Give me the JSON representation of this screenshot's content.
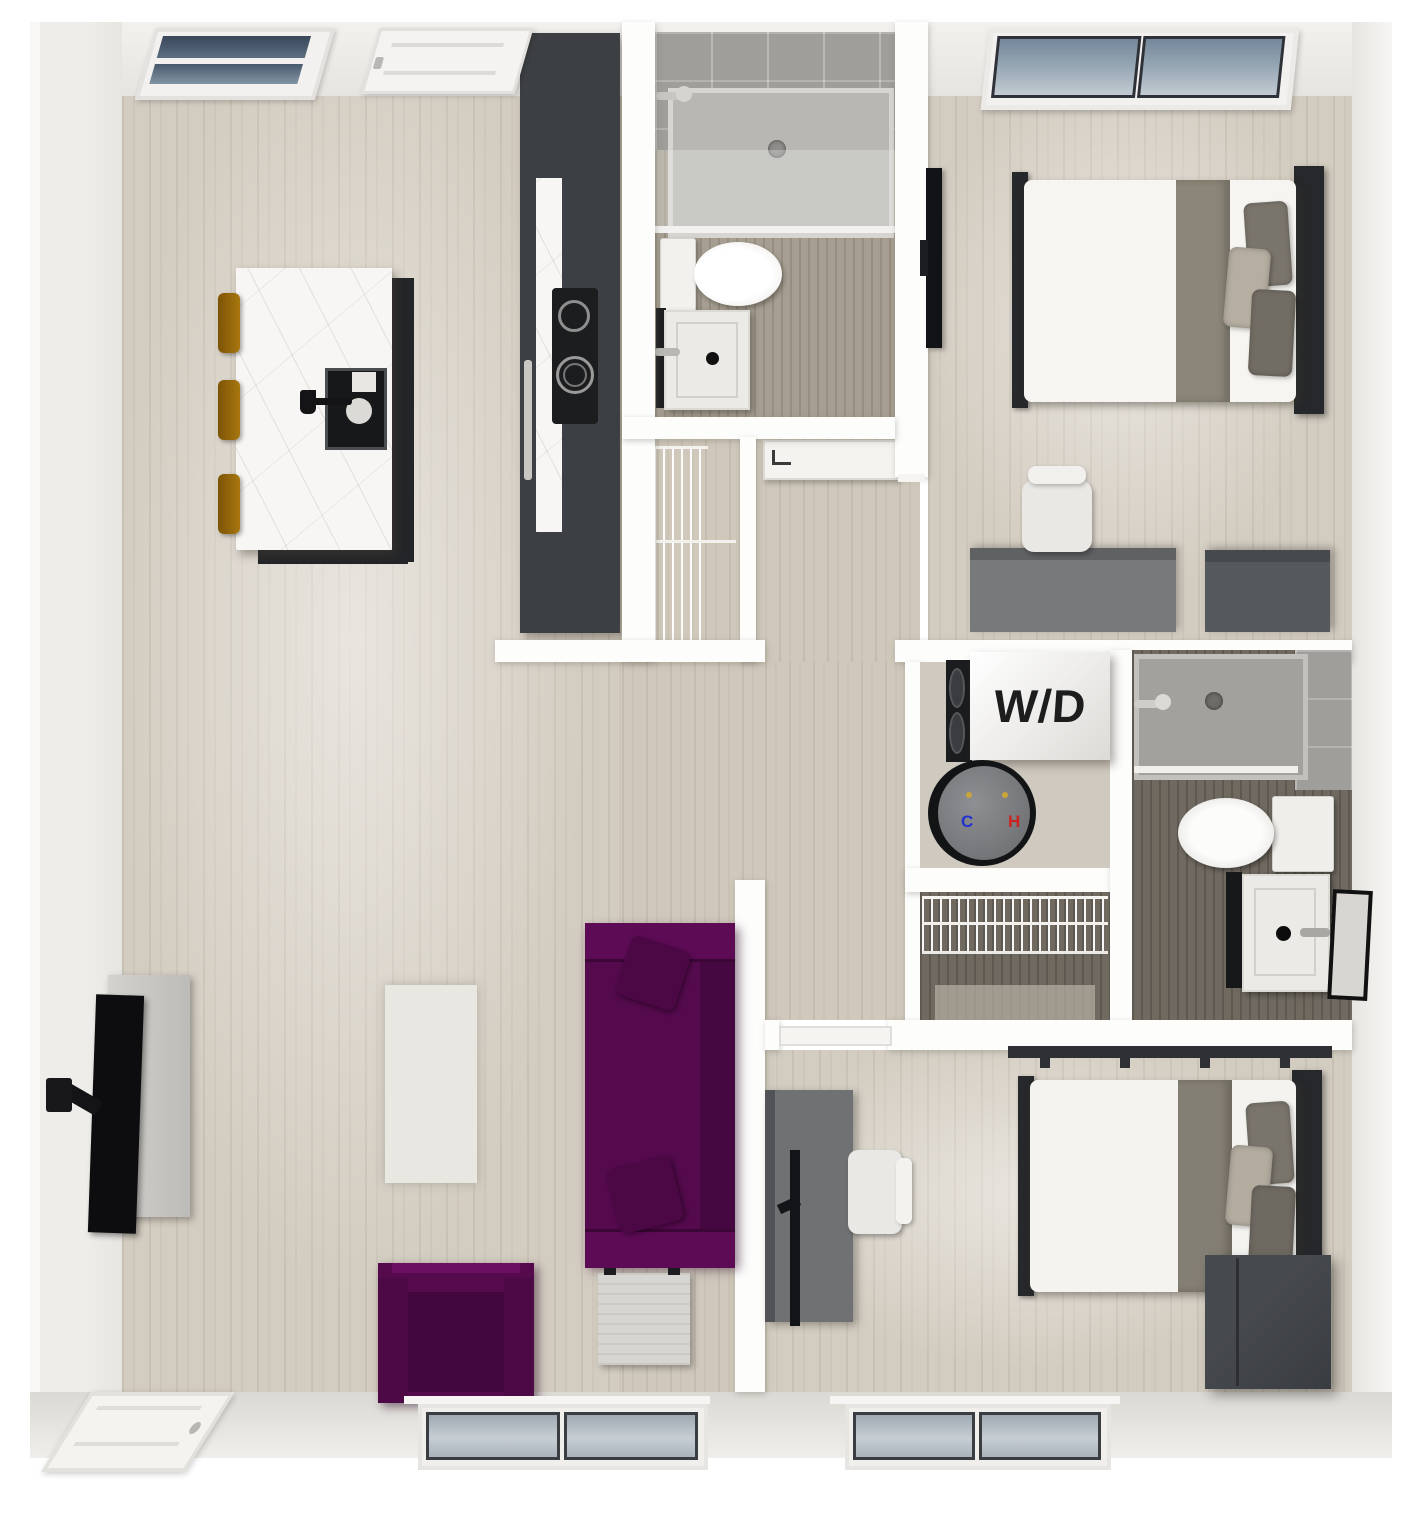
{
  "labels": {
    "washer_dryer": "W/D",
    "water_heater_cold": "C",
    "water_heater_hot": "H"
  },
  "colors": {
    "accent_purple": "#540a4d",
    "accent_purple_dark": "#420740",
    "stool_amber": "#9c6c12",
    "cabinet_dark": "#3c3f43",
    "desk_gray": "#75777a",
    "blanket_gray": "#8b8679",
    "floor_wood_light": "#d3ccc0",
    "floor_wood_dark": "#6f6960",
    "tile_gray": "#a09e9a",
    "wall_white": "#fdfdfc",
    "cold_label_color": "#2233cc",
    "hot_label_color": "#cc2222"
  }
}
